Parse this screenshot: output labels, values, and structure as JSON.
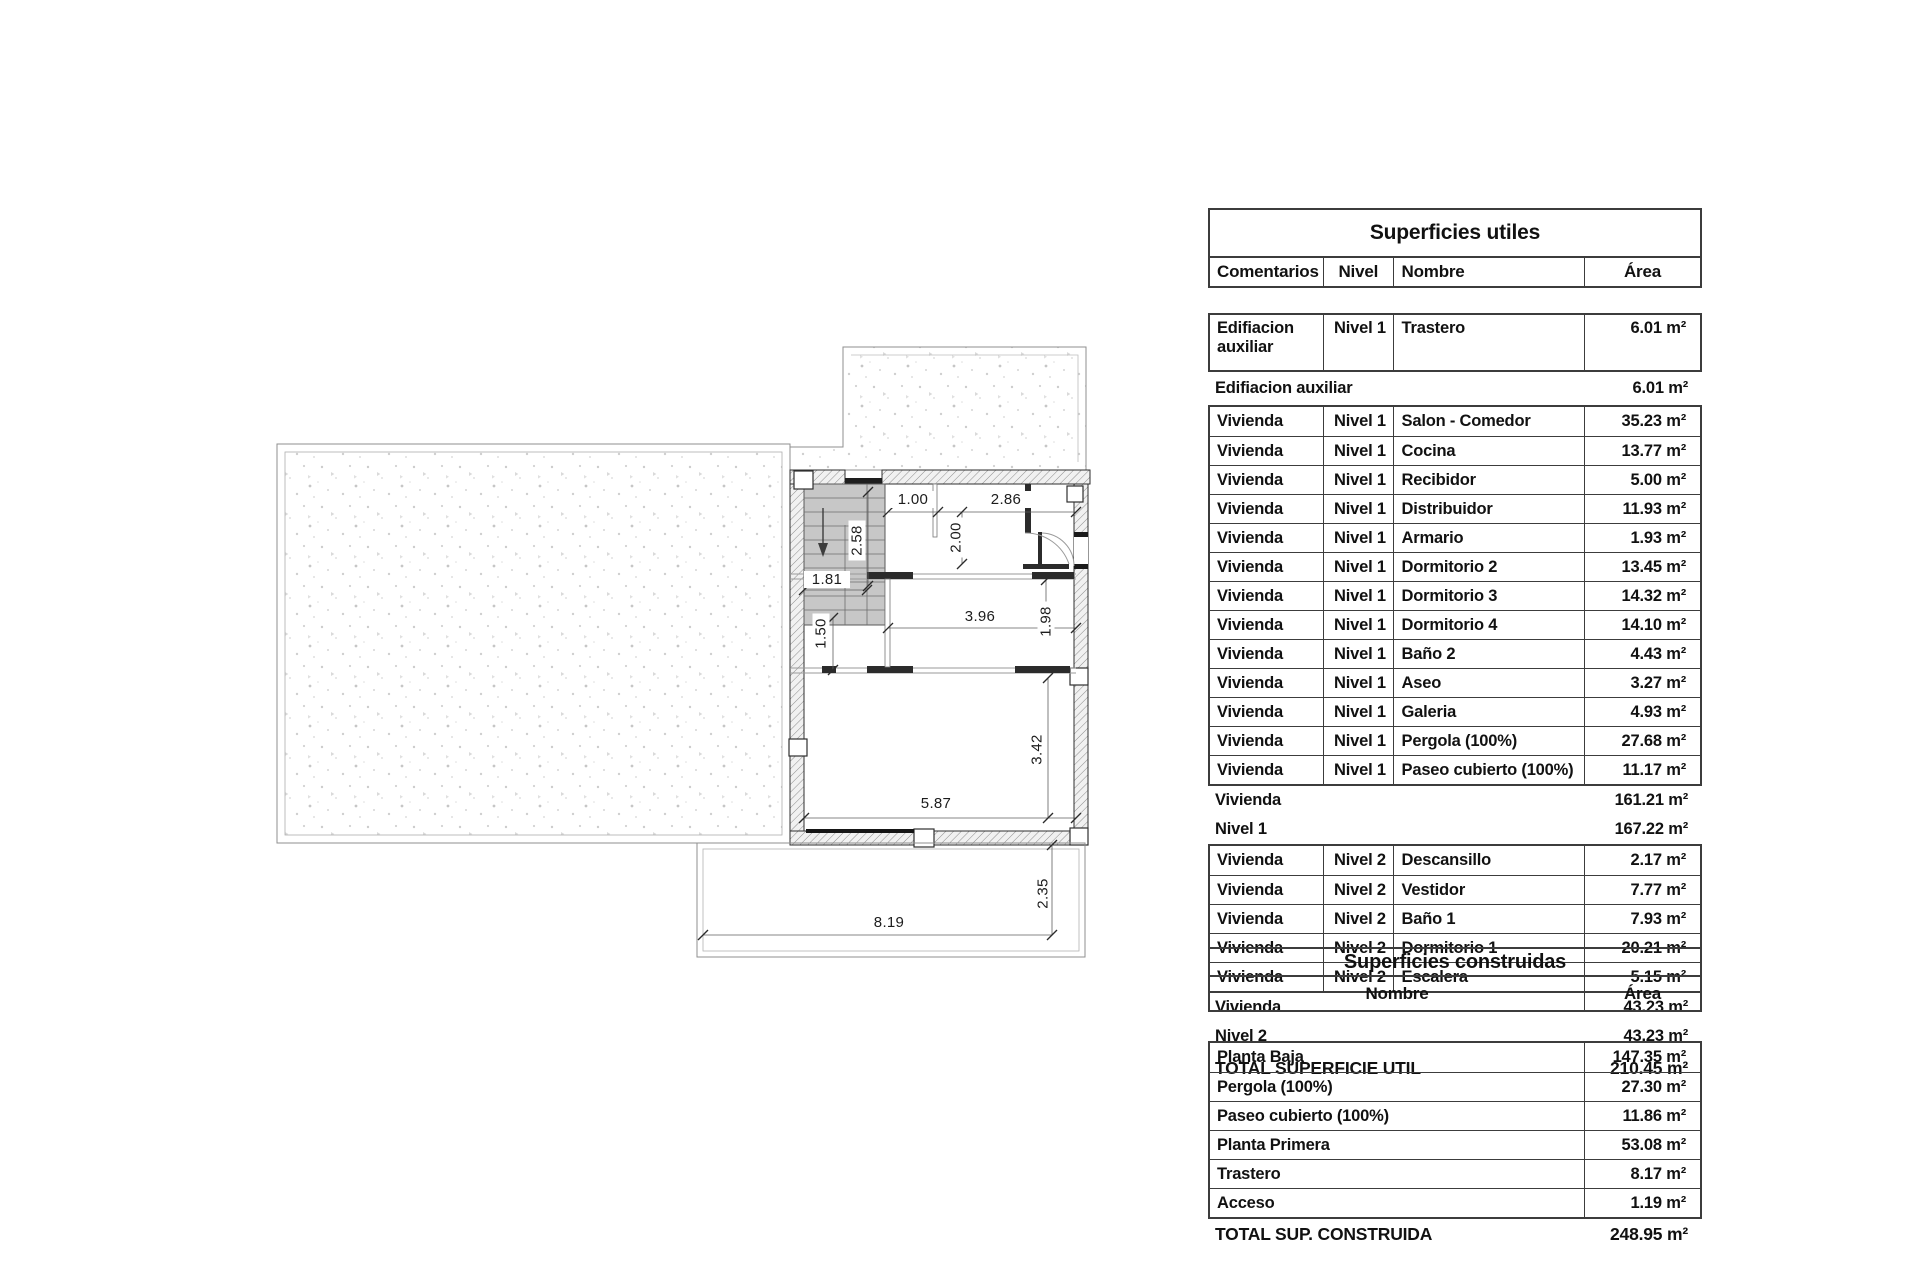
{
  "plan": {
    "dims": [
      "1.00",
      "2.86",
      "2.00",
      "2.58",
      "1.81",
      "1.50",
      "3.96",
      "1.98",
      "3.42",
      "5.87",
      "8.19",
      "2.35"
    ]
  },
  "tables": {
    "utiles": {
      "title": "Superficies utiles",
      "headers": [
        "Comentarios",
        "Nivel",
        "Nombre",
        "Área"
      ],
      "groupA": {
        "rows": [
          [
            "Edifiacion auxiliar",
            "Nivel 1",
            "Trastero",
            "6.01 m²"
          ]
        ],
        "summary": {
          "label": "Edifiacion auxiliar",
          "value": "6.01 m²"
        }
      },
      "groupB": {
        "rows": [
          [
            "Vivienda",
            "Nivel 1",
            "Salon - Comedor",
            "35.23 m²"
          ],
          [
            "Vivienda",
            "Nivel 1",
            "Cocina",
            "13.77 m²"
          ],
          [
            "Vivienda",
            "Nivel 1",
            "Recibidor",
            "5.00 m²"
          ],
          [
            "Vivienda",
            "Nivel 1",
            "Distribuidor",
            "11.93 m²"
          ],
          [
            "Vivienda",
            "Nivel 1",
            "Armario",
            "1.93 m²"
          ],
          [
            "Vivienda",
            "Nivel 1",
            "Dormitorio 2",
            "13.45 m²"
          ],
          [
            "Vivienda",
            "Nivel 1",
            "Dormitorio 3",
            "14.32 m²"
          ],
          [
            "Vivienda",
            "Nivel 1",
            "Dormitorio 4",
            "14.10 m²"
          ],
          [
            "Vivienda",
            "Nivel 1",
            "Baño 2",
            "4.43 m²"
          ],
          [
            "Vivienda",
            "Nivel 1",
            "Aseo",
            "3.27 m²"
          ],
          [
            "Vivienda",
            "Nivel 1",
            "Galeria",
            "4.93 m²"
          ],
          [
            "Vivienda",
            "Nivel 1",
            "Pergola (100%)",
            "27.68 m²"
          ],
          [
            "Vivienda",
            "Nivel 1",
            "Paseo cubierto (100%)",
            "11.17 m²"
          ]
        ],
        "summaries": [
          {
            "label": "Vivienda",
            "value": "161.21 m²"
          },
          {
            "label": "Nivel 1",
            "value": "167.22 m²"
          }
        ]
      },
      "groupC": {
        "rows": [
          [
            "Vivienda",
            "Nivel 2",
            "Descansillo",
            "2.17 m²"
          ],
          [
            "Vivienda",
            "Nivel 2",
            "Vestidor",
            "7.77 m²"
          ],
          [
            "Vivienda",
            "Nivel 2",
            "Baño 1",
            "7.93 m²"
          ],
          [
            "Vivienda",
            "Nivel 2",
            "Dormitorio 1",
            "20.21 m²"
          ],
          [
            "Vivienda",
            "Nivel 2",
            "Escalera",
            "5.15 m²"
          ]
        ],
        "summaries": [
          {
            "label": "Vivienda",
            "value": "43.23 m²"
          },
          {
            "label": "Nivel 2",
            "value": "43.23 m²"
          }
        ]
      },
      "total": {
        "label": "TOTAL SUPERFICIE UTIL",
        "value": "210.45 m²"
      }
    },
    "construidas": {
      "title": "Superficies construidas",
      "headers": [
        "Nombre",
        "Área"
      ],
      "rows": [
        [
          "Planta Baja",
          "147.35 m²"
        ],
        [
          "Pergola (100%)",
          "27.30 m²"
        ],
        [
          "Paseo cubierto (100%)",
          "11.86 m²"
        ],
        [
          "Planta Primera",
          "53.08 m²"
        ],
        [
          "Trastero",
          "8.17 m²"
        ],
        [
          "Acceso",
          "1.19 m²"
        ]
      ],
      "total": {
        "label": "TOTAL SUP. CONSTRUIDA",
        "value": "248.95 m²"
      }
    }
  }
}
